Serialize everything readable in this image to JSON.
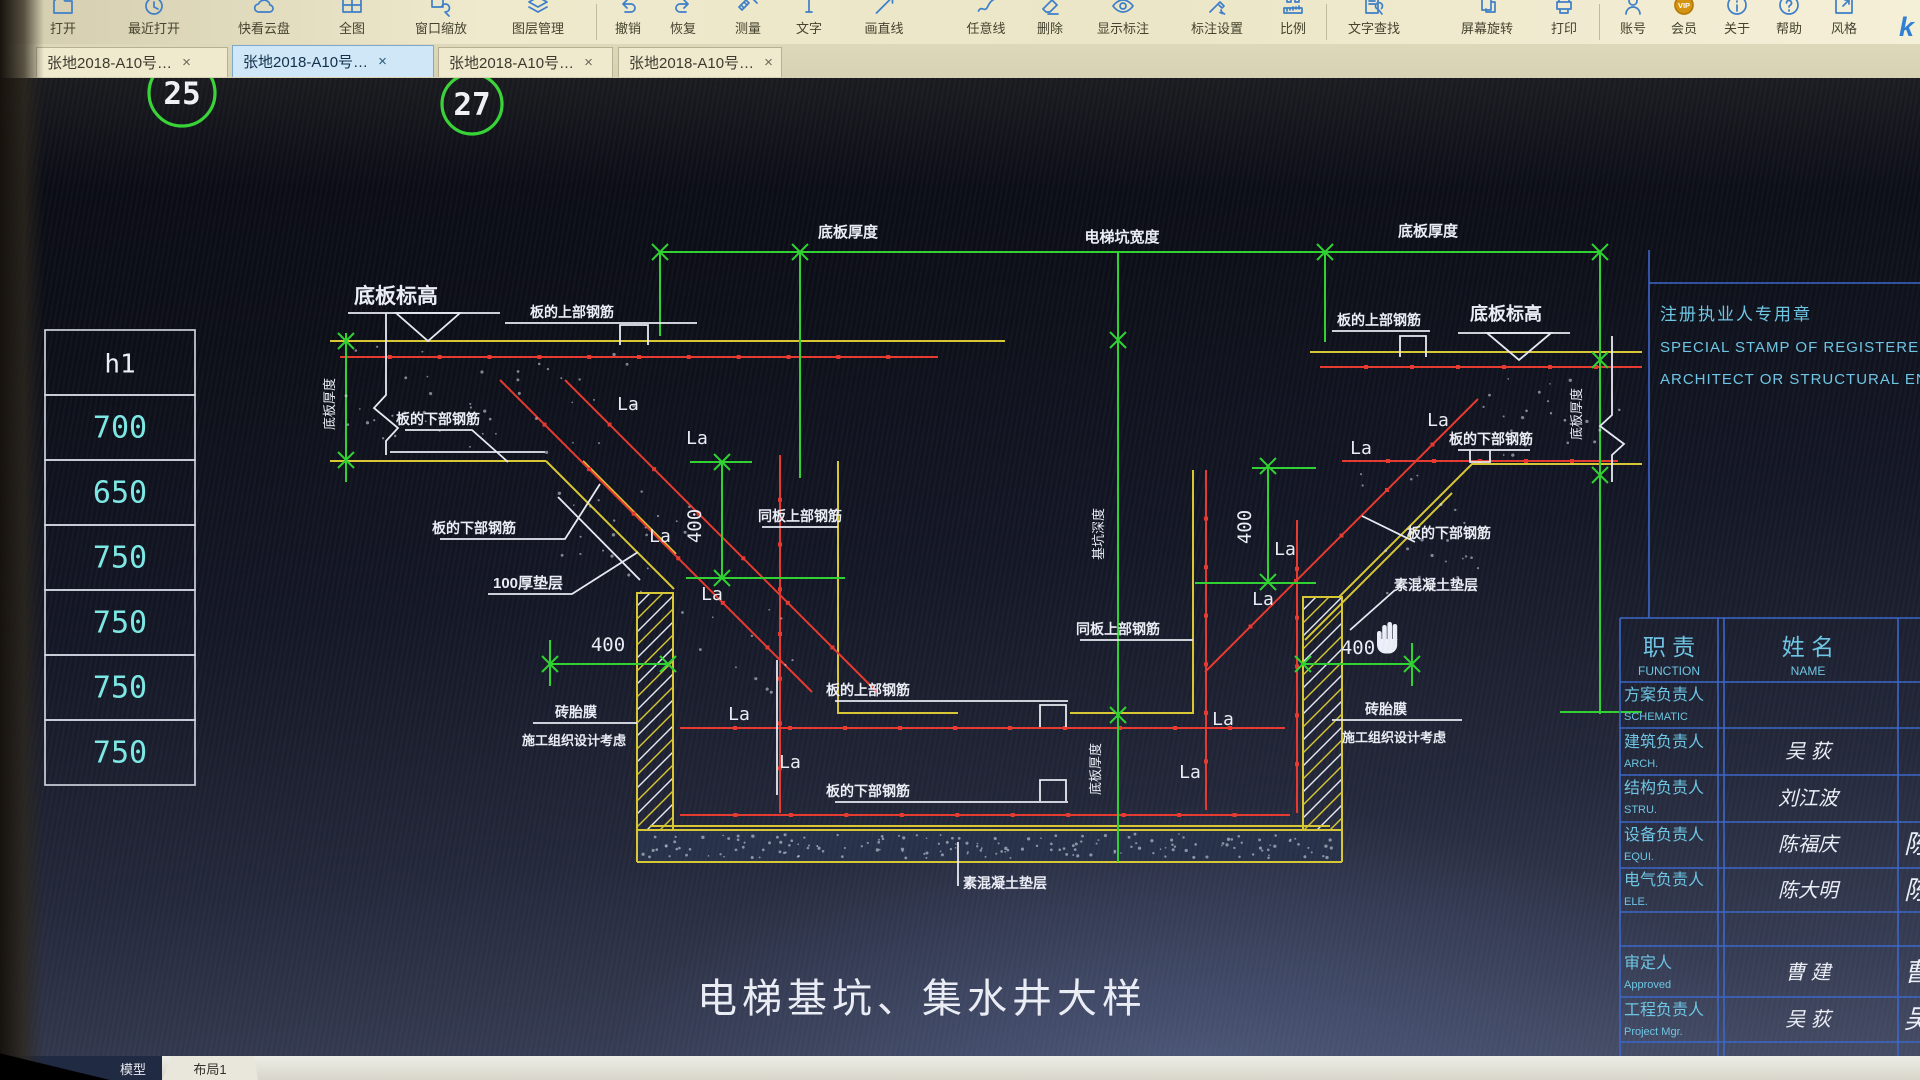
{
  "app_logo": "k",
  "toolbar": {
    "items": [
      {
        "label": "打开",
        "icon": "folder"
      },
      {
        "label": "最近打开",
        "icon": "clock"
      },
      {
        "label": "快看云盘",
        "icon": "cloud"
      },
      {
        "label": "全图",
        "icon": "fullmap"
      },
      {
        "label": "窗口缩放",
        "icon": "zoomwin"
      },
      {
        "label": "图层管理",
        "icon": "layers"
      },
      {
        "label": "撤销",
        "icon": "undo"
      },
      {
        "label": "恢复",
        "icon": "redo"
      },
      {
        "label": "测量",
        "icon": "measure"
      },
      {
        "label": "文字",
        "icon": "text"
      },
      {
        "label": "画直线",
        "icon": "line"
      },
      {
        "label": "任意线",
        "icon": "freeline"
      },
      {
        "label": "删除",
        "icon": "eraser"
      },
      {
        "label": "显示标注",
        "icon": "eye"
      },
      {
        "label": "标注设置",
        "icon": "gearpen"
      },
      {
        "label": "比例",
        "icon": "scale"
      },
      {
        "label": "文字查找",
        "icon": "findtext"
      },
      {
        "label": "屏幕旋转",
        "icon": "rotate"
      },
      {
        "label": "打印",
        "icon": "print"
      },
      {
        "label": "账号",
        "icon": "person"
      },
      {
        "label": "会员",
        "icon": "vip"
      },
      {
        "label": "关于",
        "icon": "info"
      },
      {
        "label": "帮助",
        "icon": "question"
      },
      {
        "label": "风格",
        "icon": "style"
      }
    ]
  },
  "tabs": {
    "close_glyph": "×",
    "items": [
      {
        "label": "张地2018-A10号…",
        "active": false
      },
      {
        "label": "张地2018-A10号…",
        "active": true
      },
      {
        "label": "张地2018-A10号…",
        "active": false
      },
      {
        "label": "张地2018-A10号…",
        "active": false
      }
    ]
  },
  "canvas": {
    "detail_bubbles": [
      {
        "number": "25",
        "x": 182,
        "y": 93,
        "r": 33
      },
      {
        "number": "27",
        "x": 472,
        "y": 104,
        "r": 30
      }
    ],
    "left_table": {
      "header": "h1",
      "values": [
        "700",
        "650",
        "750",
        "750",
        "750",
        "750"
      ]
    },
    "labels": [
      {
        "t": "底板厚度",
        "x": 848,
        "y": 237,
        "s": 15,
        "b": 1
      },
      {
        "t": "电梯坑宽度",
        "x": 1122,
        "y": 242,
        "s": 15,
        "b": 1
      },
      {
        "t": "底板厚度",
        "x": 1428,
        "y": 236,
        "s": 15,
        "b": 1
      },
      {
        "t": "底板标高",
        "x": 396,
        "y": 303,
        "s": 21,
        "b": 1
      },
      {
        "t": "板的上部钢筋",
        "x": 572,
        "y": 317,
        "s": 14,
        "b": 1
      },
      {
        "t": "底板厚度",
        "x": 334,
        "y": 404,
        "s": 13,
        "rot": 1
      },
      {
        "t": "板的下部钢筋",
        "x": 438,
        "y": 424,
        "s": 14,
        "b": 1
      },
      {
        "t": "La",
        "x": 628,
        "y": 410,
        "s": 18
      },
      {
        "t": "La",
        "x": 697,
        "y": 444,
        "s": 18
      },
      {
        "t": "板的下部钢筋",
        "x": 474,
        "y": 533,
        "s": 14,
        "b": 1
      },
      {
        "t": "La",
        "x": 660,
        "y": 542,
        "s": 18
      },
      {
        "t": "La",
        "x": 712,
        "y": 600,
        "s": 18
      },
      {
        "t": "100厚垫层",
        "x": 528,
        "y": 588,
        "s": 15,
        "b": 1
      },
      {
        "t": "400",
        "x": 701,
        "y": 526,
        "s": 19,
        "rot": 1
      },
      {
        "t": "400",
        "x": 608,
        "y": 651,
        "s": 19
      },
      {
        "t": "同板上部钢筋",
        "x": 800,
        "y": 521,
        "s": 14,
        "b": 1
      },
      {
        "t": "砖胎膜",
        "x": 576,
        "y": 717,
        "s": 14,
        "b": 1
      },
      {
        "t": "施工组织设计考虑",
        "x": 574,
        "y": 745,
        "s": 13,
        "b": 1
      },
      {
        "t": "板的上部钢筋",
        "x": 868,
        "y": 695,
        "s": 14,
        "b": 1
      },
      {
        "t": "La",
        "x": 739,
        "y": 720,
        "s": 18
      },
      {
        "t": "La",
        "x": 790,
        "y": 768,
        "s": 18
      },
      {
        "t": "板的下部钢筋",
        "x": 868,
        "y": 796,
        "s": 14,
        "b": 1
      },
      {
        "t": "素混凝土垫层",
        "x": 963,
        "y": 888,
        "s": 14,
        "b": 1,
        "anchor": "start"
      },
      {
        "t": "基坑深度",
        "x": 1103,
        "y": 534,
        "s": 13,
        "rot": 1
      },
      {
        "t": "底板厚度",
        "x": 1100,
        "y": 769,
        "s": 13,
        "rot": 1
      },
      {
        "t": "同板上部钢筋",
        "x": 1118,
        "y": 634,
        "s": 14,
        "b": 1
      },
      {
        "t": "400",
        "x": 1251,
        "y": 527,
        "s": 19,
        "rot": 1
      },
      {
        "t": "La",
        "x": 1223,
        "y": 725,
        "s": 18
      },
      {
        "t": "La",
        "x": 1190,
        "y": 778,
        "s": 18
      },
      {
        "t": "La",
        "x": 1438,
        "y": 426,
        "s": 18
      },
      {
        "t": "La",
        "x": 1361,
        "y": 454,
        "s": 18
      },
      {
        "t": "La",
        "x": 1285,
        "y": 555,
        "s": 18
      },
      {
        "t": "La",
        "x": 1263,
        "y": 605,
        "s": 18
      },
      {
        "t": "板的下部钢筋",
        "x": 1491,
        "y": 444,
        "s": 14,
        "b": 1
      },
      {
        "t": "板的下部钢筋",
        "x": 1449,
        "y": 538,
        "s": 14,
        "b": 1
      },
      {
        "t": "素混凝土垫层",
        "x": 1436,
        "y": 590,
        "s": 14,
        "b": 1
      },
      {
        "t": "400",
        "x": 1358,
        "y": 654,
        "s": 19
      },
      {
        "t": "砖胎膜",
        "x": 1386,
        "y": 714,
        "s": 14,
        "b": 1
      },
      {
        "t": "施工组织设计考虑",
        "x": 1394,
        "y": 742,
        "s": 13,
        "b": 1
      },
      {
        "t": "板的上部钢筋",
        "x": 1379,
        "y": 325,
        "s": 14,
        "b": 1
      },
      {
        "t": "底板标高",
        "x": 1506,
        "y": 320,
        "s": 18,
        "b": 1
      },
      {
        "t": "底板厚度",
        "x": 1581,
        "y": 414,
        "s": 13,
        "rot": 1
      },
      {
        "t": "电梯基坑、集水井大样",
        "x": 922,
        "y": 1012,
        "s": 40,
        "name": "drawing-title",
        "ls": 5
      }
    ]
  },
  "title_block": {
    "stamp": [
      "注册执业人专用章",
      "SPECIAL STAMP OF REGISTERED",
      "ARCHITECT OR STRUCTURAL ENGINEER"
    ],
    "headers": [
      {
        "zh": "职  责",
        "en": "FUNCTION"
      },
      {
        "zh": "姓  名",
        "en": "NAME"
      }
    ],
    "rows": [
      {
        "zh": "方案负责人",
        "en": "SCHEMATIC",
        "name": "",
        "sig": ""
      },
      {
        "zh": "建筑负责人",
        "en": "ARCH.",
        "name": "吴 荻",
        "sig": ""
      },
      {
        "zh": "结构负责人",
        "en": "STRU.",
        "name": "刘江波",
        "sig": ""
      },
      {
        "zh": "设备负责人",
        "en": "EQUI.",
        "name": "陈福庆",
        "sig": "陈"
      },
      {
        "zh": "电气负责人",
        "en": "ELE.",
        "name": "陈大明",
        "sig": "陈"
      }
    ],
    "rows2": [
      {
        "zh": "审定人",
        "en": "Approved",
        "name": "曹 建",
        "sig": "曹"
      },
      {
        "zh": "工程负责人",
        "en": "Project Mgr.",
        "name": "吴 荻",
        "sig": "吴"
      }
    ]
  },
  "statusbar": {
    "model_label": "模型",
    "layout_tab": "布局1"
  },
  "colors": {
    "dim_green": "#2fd32f",
    "formwork_yellow": "#d9c832",
    "rebar_red": "#e8392e",
    "cad_white": "#e9ebf2",
    "table_cyan": "#7de9e4",
    "block_blue": "#3b66c8",
    "block_cyan": "#6ec6e4"
  }
}
